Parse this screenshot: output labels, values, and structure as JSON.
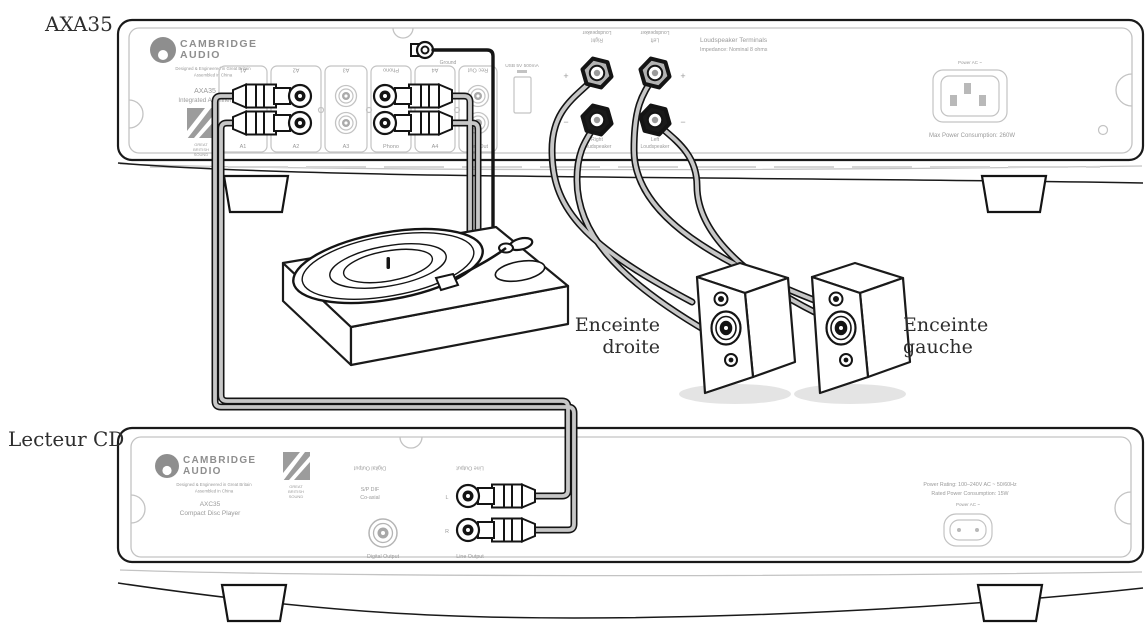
{
  "page": {
    "background": "#ffffff",
    "width": 1148,
    "height": 629
  },
  "annotations": {
    "amplifier_label": "AXA35",
    "cd_label": "Lecteur CD",
    "speaker_right": {
      "line1": "Enceinte",
      "line2": "droite"
    },
    "speaker_left": {
      "line1": "Enceinte",
      "line2": "gauche"
    }
  },
  "amplifier": {
    "brand": {
      "name_line1": "CAMBRIDGE",
      "name_line2": "AUDIO",
      "tagline1": "Designed & Engineered in Great Britain",
      "tagline2": "Assembled in China",
      "model": "AXA35",
      "model_desc": "Integrated Amplifier",
      "badge_line1": "GREAT",
      "badge_line2": "BRITISH",
      "badge_line3": "SOUND"
    },
    "inputs": [
      "A1",
      "A2",
      "A3",
      "Phono",
      "A4",
      "Rec Out"
    ],
    "ground_label": "Ground",
    "usb_label": "USB 5V 500mA",
    "speaker_terminals": {
      "title": "Loudspeaker Terminals",
      "subtitle": "Impedance: Nominal 8 ohms",
      "plus": "+",
      "minus": "−",
      "right_line1": "Right",
      "right_line2": "Loudspeaker",
      "left_line1": "Left",
      "left_line2": "Loudspeaker"
    },
    "power": {
      "ac_label": "Power AC ~",
      "consumption": "Max Power Consumption: 260W"
    }
  },
  "cd_player": {
    "brand": {
      "name_line1": "CAMBRIDGE",
      "name_line2": "AUDIO",
      "tagline1": "Designed & Engineered in Great Britain",
      "tagline2": "Assembled in China",
      "model": "AXC35",
      "model_desc": "Compact Disc Player",
      "badge_line1": "GREAT",
      "badge_line2": "BRITISH",
      "badge_line3": "SOUND"
    },
    "digital_output": {
      "label": "Digital Output",
      "type_line1": "S/P DIF",
      "type_line2": "Co-axial"
    },
    "line_output": {
      "label": "Line Output",
      "left_channel": "L",
      "right_channel": "R"
    },
    "power": {
      "rating": "Power Rating: 100–240V AC ~ 50/60Hz",
      "consumption": "Rated Power Consumption: 15W",
      "ac_label": "Power AC ~"
    }
  },
  "colors": {
    "line": "#1a1a1a",
    "panel_line": "#c3c3c3",
    "panel_text": "#9a9a9a",
    "cable_fill": "#c7c7c7",
    "knob_gray": "#b3b3b3",
    "knob_black": "#1a1a1a",
    "label_text": "#2e2e2e"
  }
}
